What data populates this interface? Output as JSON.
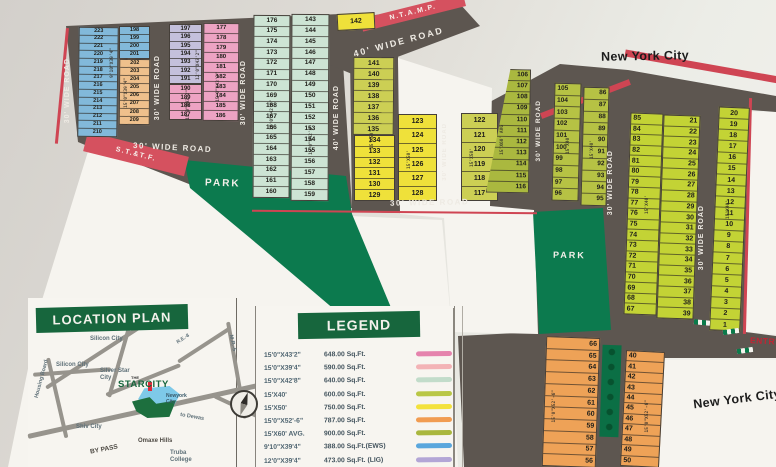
{
  "scene": {
    "city_top": "New York City",
    "city_bottom": "New York City",
    "ntamp": "N.T.A.M.P.",
    "sttf": "S.T.&T.F.",
    "entry": "ENTRY",
    "park": "PARK"
  },
  "roads": {
    "w30": "30' WIDE ROAD",
    "w40": "40' WIDE ROAD"
  },
  "dims": {
    "ews": "9'10\"X39'4\"",
    "lig": "12'0\"X43'2\"",
    "p648": "15'0\"X43'2\"",
    "p590": "15'0\"X39'4\"",
    "p640": "15'0\"X42'8\"",
    "p750": "15'X50'",
    "p900": "15'X60' AVG",
    "p600": "15'X40'",
    "p787": "15'0\"X52'-6\""
  },
  "plots": {
    "p142": "142",
    "blue_main": [
      "223",
      "222",
      "221",
      "220",
      "219",
      "218",
      "217",
      "216",
      "215",
      "214",
      "213",
      "212",
      "211",
      "210"
    ],
    "blue_top": [
      "198",
      "199",
      "200",
      "201"
    ],
    "orange_tl": [
      "202",
      "203",
      "204",
      "205",
      "206",
      "207",
      "208",
      "209"
    ],
    "lavender": [
      "197",
      "196",
      "195",
      "194",
      "193",
      "192",
      "191"
    ],
    "pink_left": [
      "190",
      "189",
      "188",
      "187"
    ],
    "pink_right": [
      "177",
      "178",
      "179",
      "180",
      "181",
      "182",
      "183",
      "184",
      "185",
      "186"
    ],
    "mint_left": [
      "176",
      "175",
      "174",
      "173",
      "172",
      "171",
      "170",
      "169",
      "168",
      "167",
      "166",
      "165",
      "164",
      "163",
      "162",
      "161",
      "160"
    ],
    "mint_right": [
      "143",
      "144",
      "145",
      "146",
      "147",
      "148",
      "149",
      "150",
      "151",
      "152",
      "153",
      "154",
      "155",
      "156",
      "157",
      "158",
      "159"
    ],
    "yellow_left_a": [
      "141",
      "140",
      "139",
      "138",
      "137",
      "136",
      "135"
    ],
    "yellow_left_b": [
      "134",
      "133",
      "132",
      "131",
      "130",
      "129"
    ],
    "yellow_mid": [
      "123",
      "124",
      "125",
      "126",
      "127",
      "128"
    ],
    "yellow_right": [
      "122",
      "121",
      "120",
      "119",
      "118",
      "117"
    ],
    "olive_left": [
      "106",
      "107",
      "108",
      "109",
      "110",
      "111",
      "112",
      "113",
      "114",
      "115",
      "116"
    ],
    "olive_mid": [
      "105",
      "104",
      "103",
      "102",
      "101",
      "100",
      "99",
      "98",
      "97",
      "96"
    ],
    "olive_right": [
      "86",
      "87",
      "88",
      "89",
      "90",
      "91",
      "92",
      "93",
      "94",
      "95"
    ],
    "green_a": [
      "85",
      "84",
      "83",
      "82",
      "81",
      "80",
      "79",
      "78",
      "77",
      "76",
      "75",
      "74",
      "73",
      "72",
      "71",
      "70",
      "69",
      "68",
      "67"
    ],
    "green_b": [
      "21",
      "22",
      "23",
      "24",
      "25",
      "26",
      "27",
      "28",
      "29",
      "30",
      "31",
      "32",
      "33",
      "34",
      "35",
      "36",
      "37",
      "38",
      "39"
    ],
    "green_c": [
      "20",
      "19",
      "18",
      "17",
      "16",
      "15",
      "14",
      "13",
      "12",
      "11",
      "10",
      "9",
      "8",
      "7",
      "6",
      "5",
      "4",
      "3",
      "2",
      "1"
    ],
    "orange_left": [
      "66",
      "65",
      "64",
      "63",
      "62",
      "61",
      "60",
      "59",
      "58",
      "57",
      "56"
    ],
    "orange_right": [
      "40",
      "41",
      "42",
      "43",
      "44",
      "45",
      "46",
      "47",
      "48",
      "49",
      "50"
    ]
  },
  "legend": {
    "title": "LEGEND",
    "rows": [
      {
        "size": "15'0\"X43'2\"",
        "area": "648.00 Sq.Ft.",
        "color": "#e583ad"
      },
      {
        "size": "15'0\"X39'4\"",
        "area": "590.00 Sq.Ft.",
        "color": "#f3b3b6"
      },
      {
        "size": "15'0\"X42'8\"",
        "area": "640.00 Sq.Ft.",
        "color": "#c2dcca"
      },
      {
        "size": "15'X40'",
        "area": "600.00 Sq.Ft.",
        "color": "#b9c746"
      },
      {
        "size": "15'X50'",
        "area": "750.00 Sq.Ft.",
        "color": "#f3e23c"
      },
      {
        "size": "15'0\"X52'-6\"",
        "area": "787.00 Sq.Ft.",
        "color": "#f19c51"
      },
      {
        "size": "15'X60' AVG.",
        "area": "900.00 Sq.Ft.",
        "color": "#a9b73e"
      },
      {
        "size": "9'10\"X39'4\"",
        "area": "388.00 Sq.Ft.(EWS)",
        "color": "#5aa7dd"
      },
      {
        "size": "12'0\"X39'4\"",
        "area": "473.00 Sq.Ft. (LIG)",
        "color": "#b3a6d6"
      }
    ]
  },
  "location_plan": {
    "title": "LOCATION PLAN",
    "shiv_top": "Shiv City",
    "silicon_mid": "Silicon City",
    "silicon_left": "Silicon City",
    "housing": "Housing Board",
    "silver": "Silver Star City",
    "shiv_bottom": "Shiv City",
    "bypass": "BY PASS",
    "omaxe": "Omaxe Hills",
    "dewas": "to Dewas",
    "truba": "Truba College",
    "mr5": "M.R.-5",
    "re8": "R.E.-8",
    "newyork": "Newyork City",
    "logo_the": "THE",
    "logo": "STARCITY"
  },
  "colors": {
    "road": "#5d5650",
    "park": "#0c7a4e",
    "red": "#d5515f",
    "blue": "#82b9da",
    "orange_tl": "#efc08c",
    "lavender": "#c4c0dc",
    "pink": "#eda3c3",
    "mint": "#cde4d4",
    "yellow": "#efe13a",
    "olive_yellow": "#cccf54",
    "olive": "#b0bc42",
    "green_plot": "#c3d335",
    "orange_br": "#eea257",
    "legend_green": "#17663d"
  }
}
